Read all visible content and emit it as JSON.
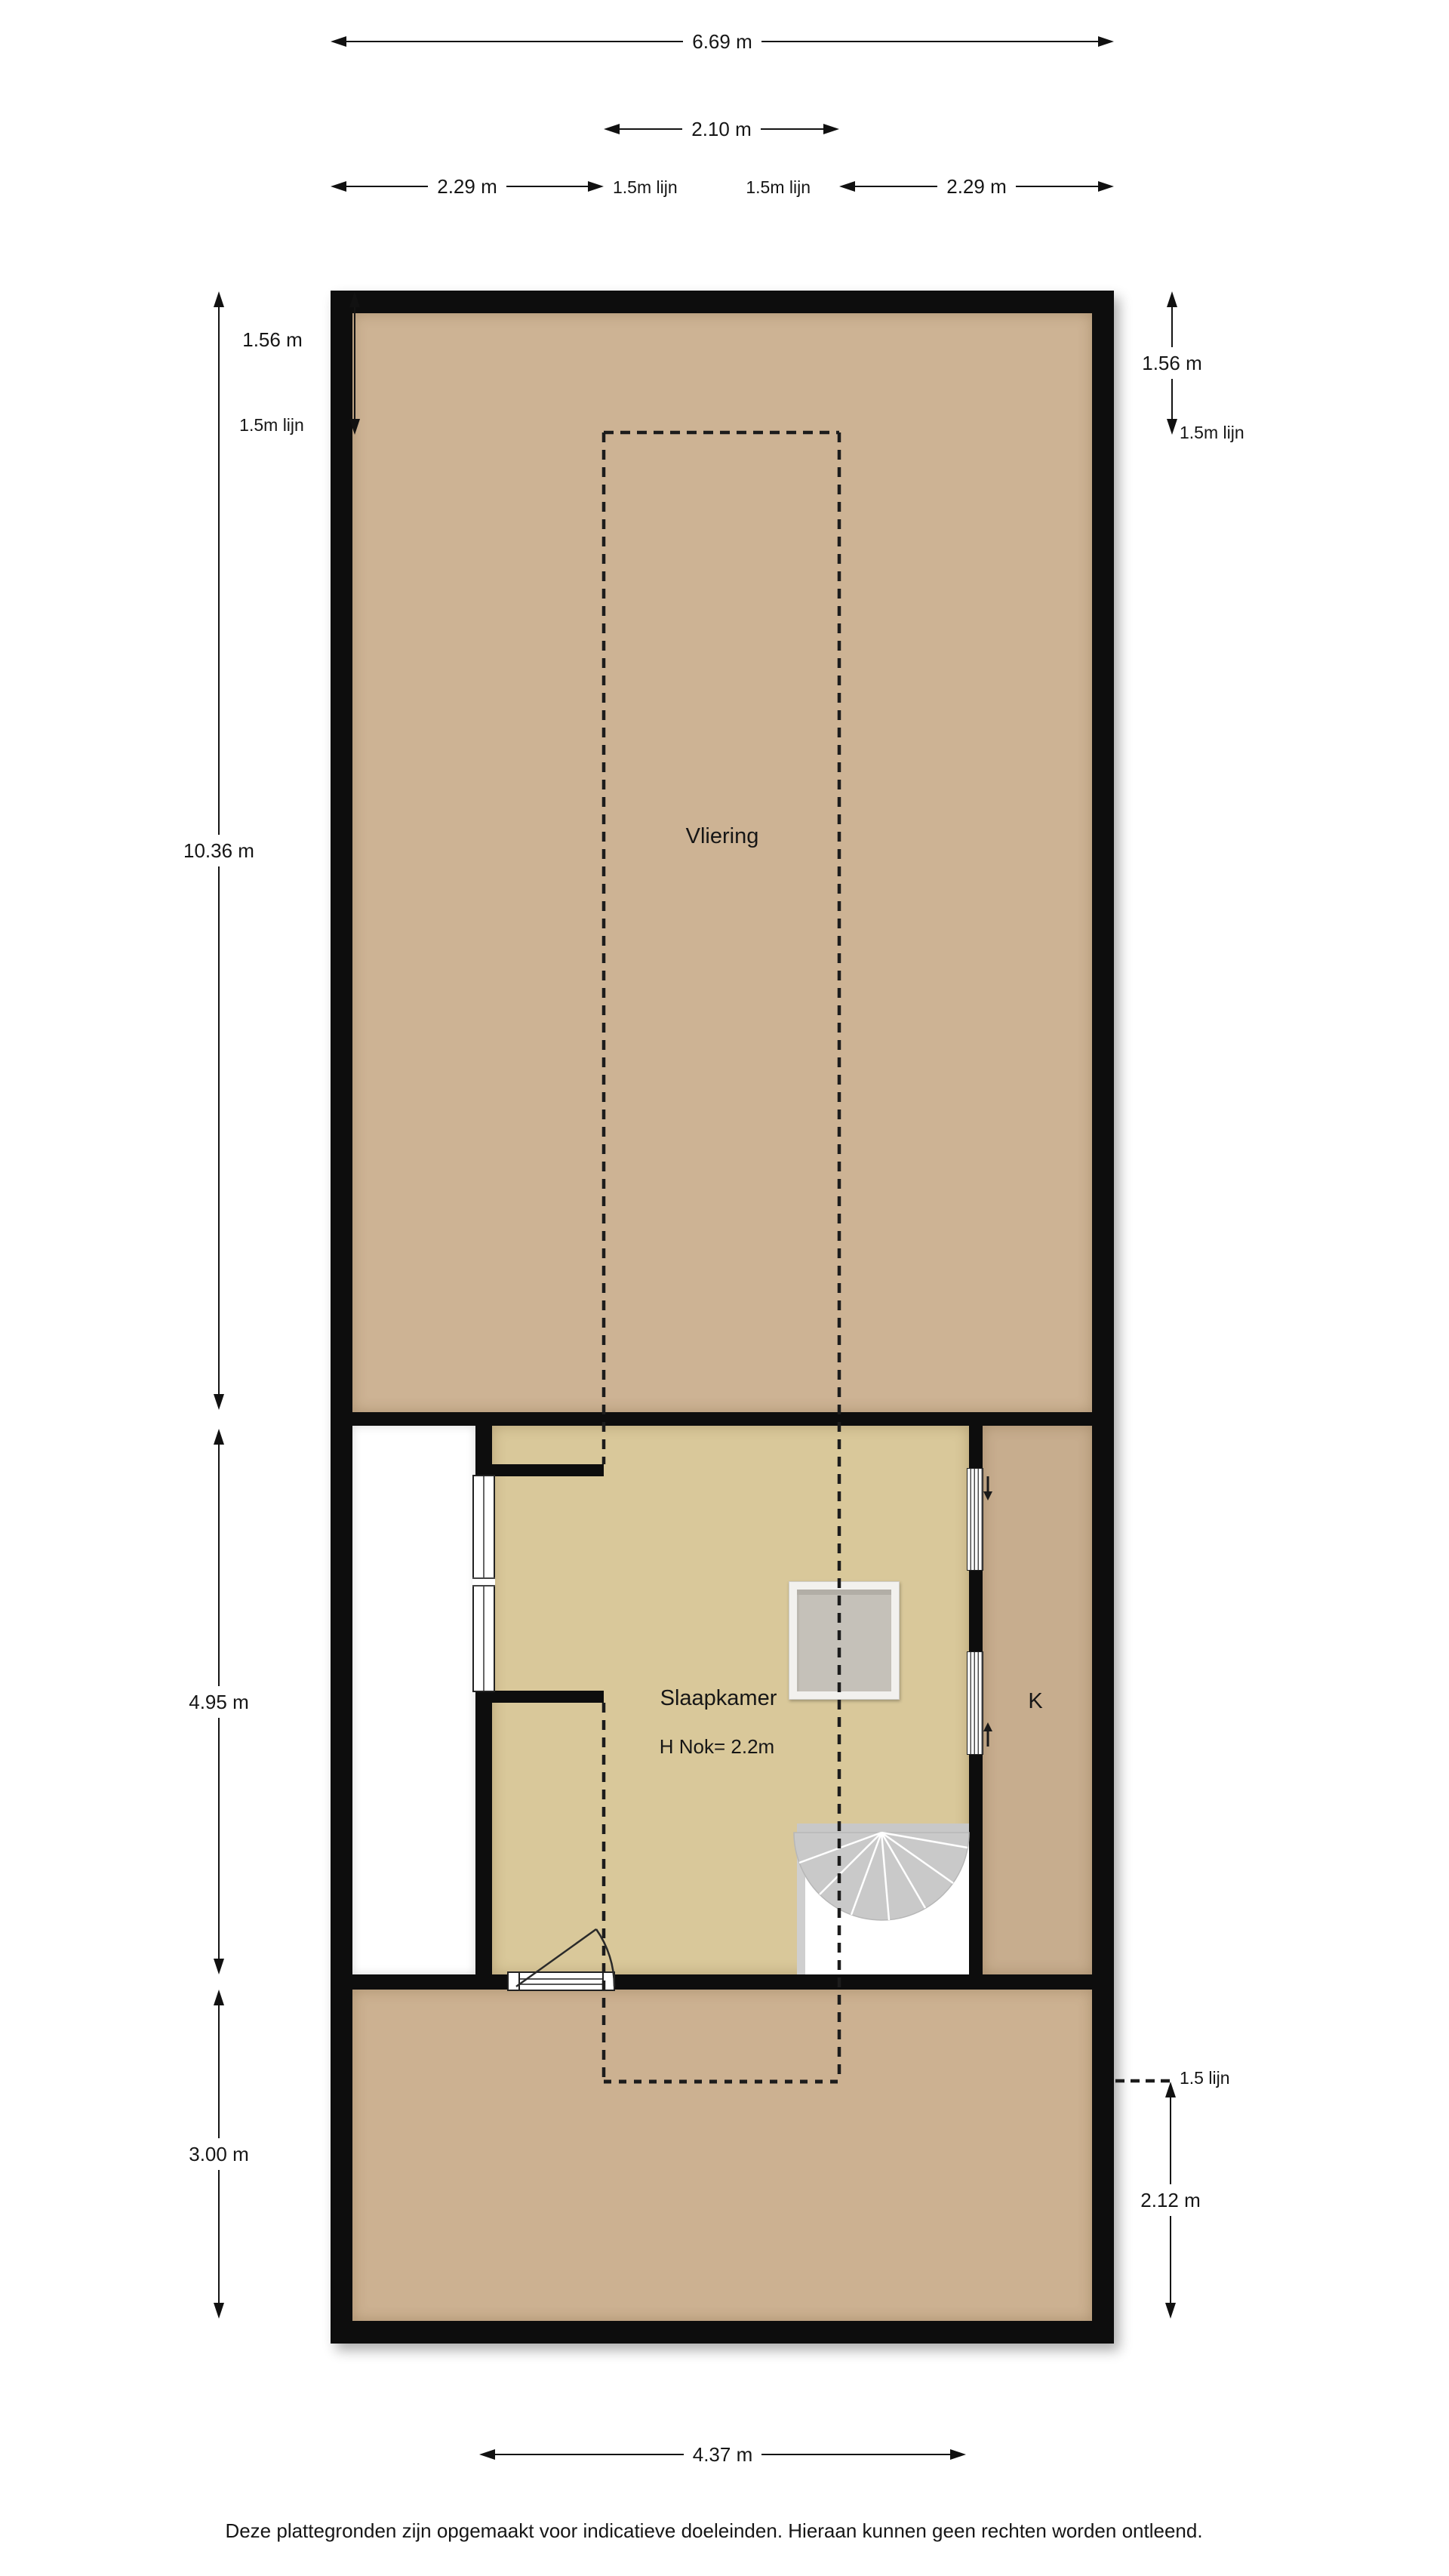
{
  "title": "Vliering / zolder plattegrond",
  "rooms": {
    "attic_label": "Vliering",
    "bedroom_label": "Slaapkamer",
    "bedroom_height": "H Nok= 2.2m",
    "closet_label": "K"
  },
  "dims": {
    "top_total": "6.69 m",
    "top_mid": "2.10 m",
    "top_left": "2.29 m",
    "top_right": "2.29 m",
    "lijn_top_left": "1.5m lijn",
    "lijn_top_right": "1.5m lijn",
    "left_attic": "1.56 m",
    "lijn_left": "1.5m lijn",
    "right_attic": "1.56 m",
    "lijn_right": "1.5m lijn",
    "left_total": "10.36 m",
    "left_mid": "4.95 m",
    "left_bottom": "3.00 m",
    "right_bottom": "2.12 m",
    "lijn_bottom_right": "1.5 lijn",
    "bottom_width": "4.37 m"
  },
  "footer": {
    "disclaimer": "Deze plattegronden zijn opgemaakt voor indicatieve doeleinden. Hieraan kunnen geen rechten worden ontleend."
  },
  "colors": {
    "wall": "#0d0d0d",
    "attic_floor": "#cdb394",
    "bedroom_floor": "#d9c89a",
    "closet_floor": "#c7ad8e",
    "lower_floor": "#ccb191",
    "stair_gray": "#c9c9c9",
    "background": "#ffffff"
  }
}
